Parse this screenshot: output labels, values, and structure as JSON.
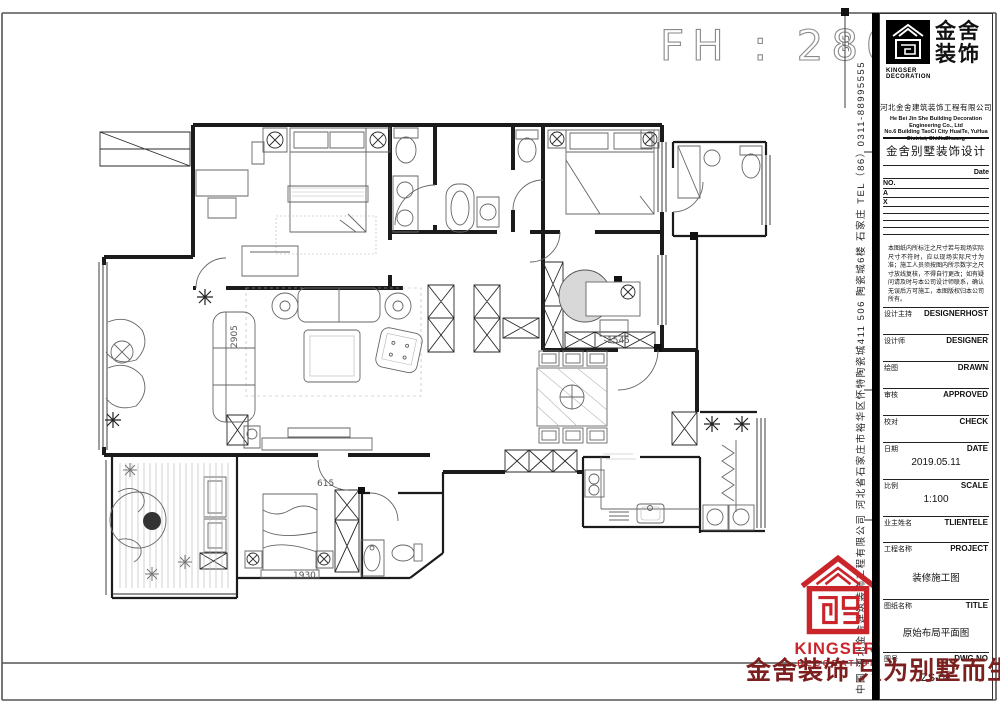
{
  "plan": {
    "fh_label": "FH : 2800",
    "dims": {
      "top_right": "555",
      "living": "2905",
      "study": "1545",
      "bedroom": "615",
      "bedroom_bottom": "1930"
    }
  },
  "title_block": {
    "logo": {
      "cn1": "金舍",
      "cn2": "装饰",
      "en1": "KINGSER",
      "en2": "DECORATION"
    },
    "company_cn": "河北金舍建筑装饰工程有限公司",
    "company_en1": "He Bei Jin She Building Decoration Engineering Co., Ltd",
    "company_en2": "No.6 Building TaoCi City HuaiTe, YuHua District, ShiJiaZhuang",
    "dept_title": "金舍别墅装饰设计",
    "date_label": "Date",
    "rev_no": "NO.",
    "rev_a": "A",
    "rev_x": "X",
    "notes": "本图纸内所标注之尺寸若与现场实际尺寸不符时，应以现场实际尺寸为准；施工人员须按图内所示数字之尺寸放线复核，不得自行更改；如有疑问请及时与本公司设计师联系，确认无误后方可施工，本图版权归本公司所有。",
    "rows": [
      {
        "cn": "设计主持",
        "en": "DESIGNERHOST",
        "value": ""
      },
      {
        "cn": "设计师",
        "en": "DESIGNER",
        "value": ""
      },
      {
        "cn": "绘图",
        "en": "DRAWN",
        "value": ""
      },
      {
        "cn": "审核",
        "en": "APPROVED",
        "value": ""
      },
      {
        "cn": "校对",
        "en": "CHECK",
        "value": ""
      },
      {
        "cn": "日期",
        "en": "DATE",
        "value": "2019.05.11"
      },
      {
        "cn": "比例",
        "en": "SCALE",
        "value": "1:100"
      },
      {
        "cn": "业主姓名",
        "en": "TLIENTELE",
        "value": ""
      },
      {
        "cn": "工程名称",
        "en": "PROJECT",
        "value": "装修施工图"
      },
      {
        "cn": "图纸名称",
        "en": "TITLE",
        "value": "原始布局平面图"
      },
      {
        "cn": "图号",
        "en": "DWG.NO",
        "value": "ZS-04"
      }
    ],
    "side_text": "中国·河北金舍建筑装饰工程有限公司 河北省石家庄市裕华区怀特陶瓷城411 506 陶瓷城6楼 石家庄 TEL（86）0311-88995555"
  },
  "red_logo": {
    "en1": "KINGSER'",
    "en2": "DECORATION"
  },
  "slogan": "金舍装饰 只为别墅而生",
  "colors": {
    "accent_red": "#c9252b",
    "slogan_red": "#7b1f1f",
    "line": "#1b1b1b"
  }
}
